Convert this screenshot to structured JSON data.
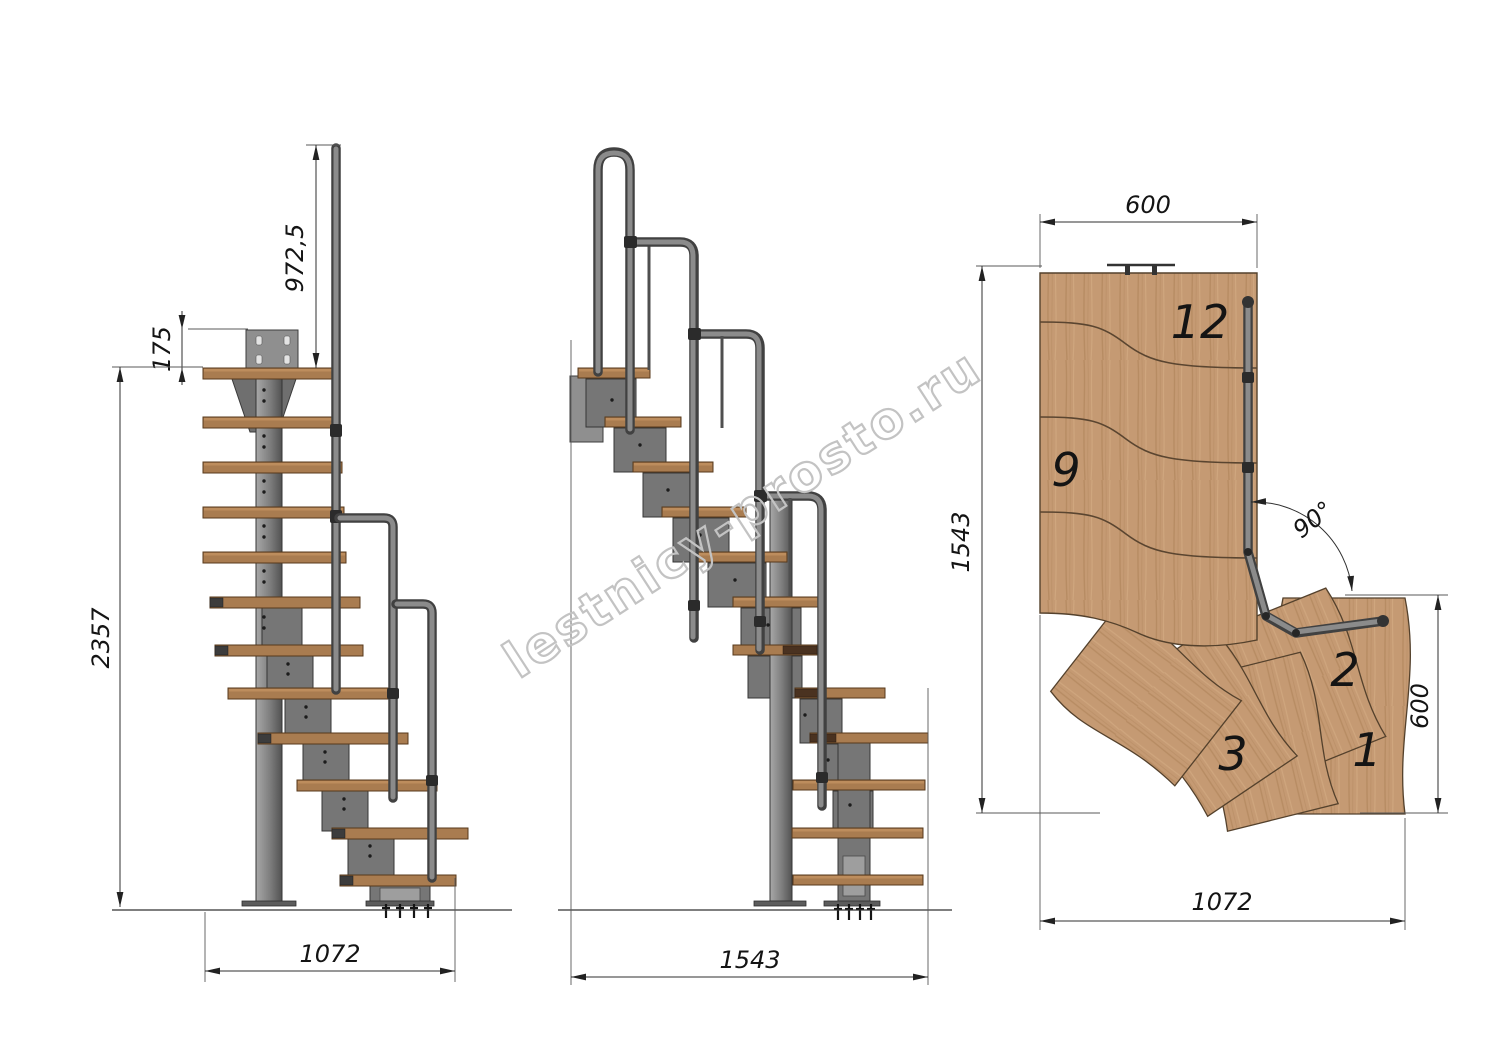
{
  "title": "Modular staircase technical drawing",
  "watermark": {
    "text": "lestnicy-prosto.ru"
  },
  "front_view": {
    "label": "front elevation",
    "dims": {
      "handrail_height": "972,5",
      "mount_plate_offset": "175",
      "total_height": "2357",
      "base_width": "1072"
    }
  },
  "side_view": {
    "label": "side elevation",
    "dims": {
      "base_length": "1543"
    }
  },
  "plan_view": {
    "label": "top plan",
    "dims": {
      "upper_flight_width": "600",
      "overall_length": "1543",
      "turn_angle": "90°",
      "entry_depth": "600",
      "overall_width": "1072"
    },
    "step_labels": {
      "s12": "12",
      "s9": "9",
      "s2": "2",
      "s3": "3",
      "s1": "1"
    }
  },
  "colors": {
    "plan_wood": "#c59a73",
    "tread_wood": "#a97c50",
    "metal": "#767676",
    "dimension_line": "#2f2f2f",
    "watermark": "#c3c3c3"
  }
}
